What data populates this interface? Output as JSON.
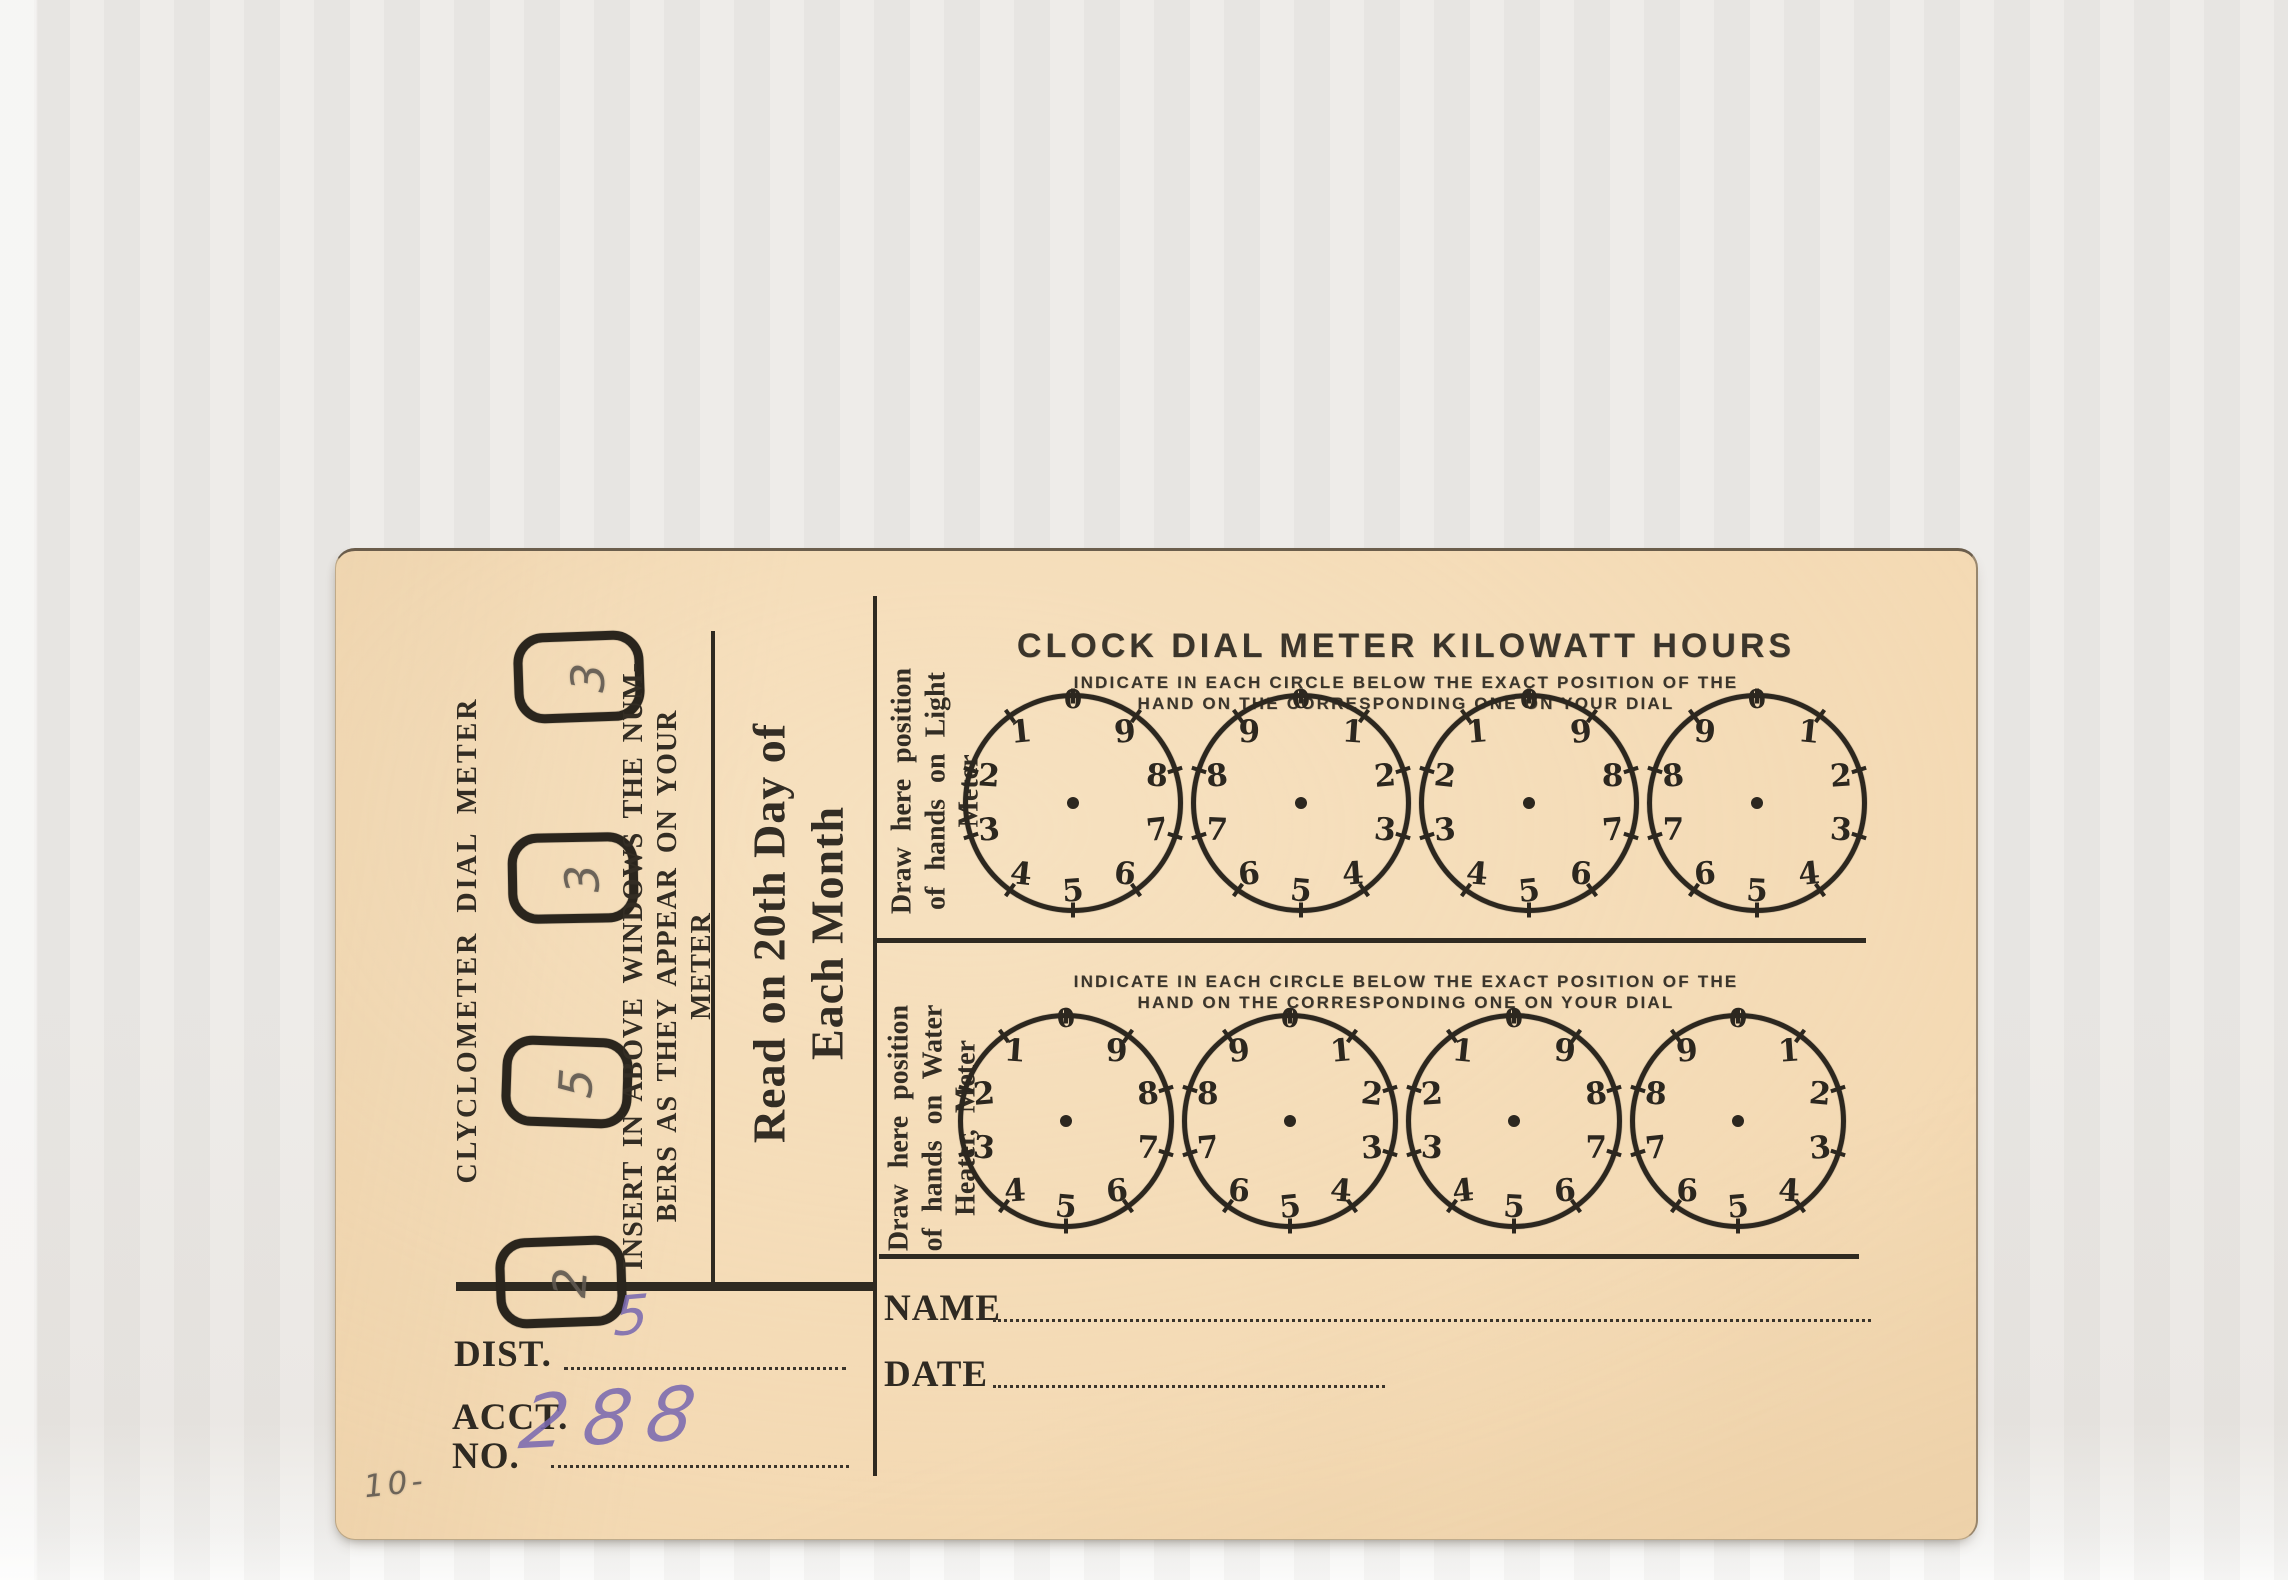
{
  "card": {
    "colors": {
      "paper": "#f3d8b1",
      "ink": "#332d24",
      "pencil": "#5f5850",
      "pen_purple": "#7b6ab0"
    },
    "left": {
      "vertical_title": "CLYCLOMETER DIAL METER",
      "windows": [
        "3",
        "3",
        "5",
        "2"
      ],
      "insert_lines": [
        "INSERT IN ABOVE WINDOWS THE NUM-",
        "BERS AS THEY APPEAR ON YOUR",
        "METER"
      ],
      "read_lines": [
        "Read on 20th Day of",
        "Each Month"
      ],
      "dist_label": "DIST.",
      "dist_value": "5",
      "acct_line1": "ACCT.",
      "acct_line2": "NO.",
      "acct_value": "288",
      "pencil_note": "10-"
    },
    "right": {
      "title": "CLOCK DIAL METER KILOWATT HOURS",
      "instruction_line1": "INDICATE IN EACH CIRCLE BELOW THE EXACT POSITION OF THE",
      "instruction_line2": "HAND ON THE CORRESPONDING ONE ON YOUR DIAL",
      "light_label_lines": [
        "Draw here position",
        "of hands on Light",
        "Meter"
      ],
      "water_label_lines": [
        "Draw here position",
        "of hands on Water",
        "Heater, Meter"
      ],
      "name_label": "NAME",
      "date_label": "DATE"
    },
    "dials": {
      "digits": [
        "0",
        "1",
        "2",
        "3",
        "4",
        "5",
        "6",
        "7",
        "8",
        "9"
      ],
      "top_row_directions": [
        "ccw",
        "cw",
        "ccw",
        "cw"
      ],
      "bottom_row_directions": [
        "ccw",
        "cw",
        "ccw",
        "cw"
      ]
    }
  }
}
